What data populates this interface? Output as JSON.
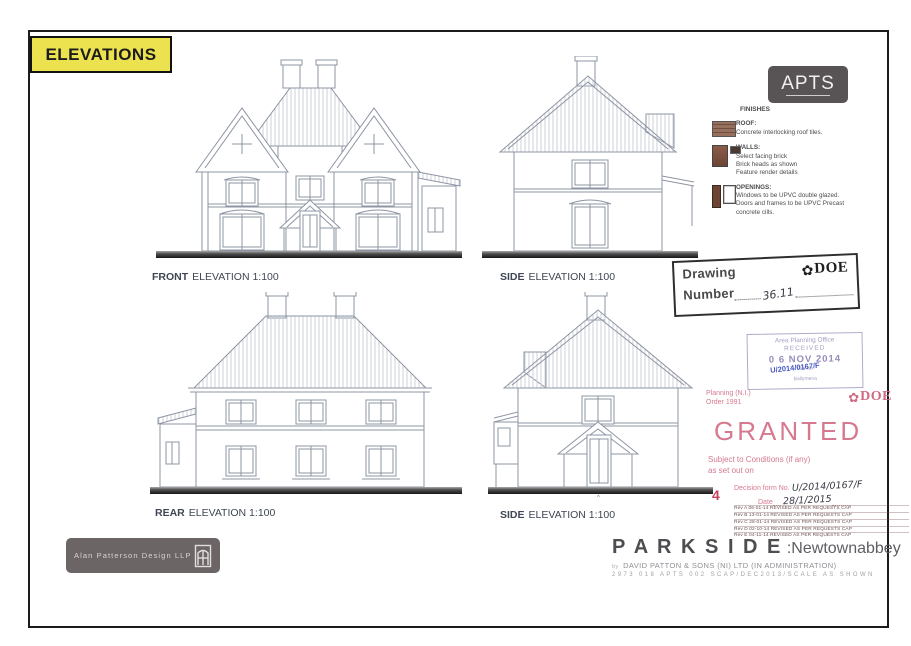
{
  "sheet": {
    "title": "ELEVATIONS"
  },
  "logos": {
    "apts": "APTS",
    "designer": "Alan Patterson Design LLP"
  },
  "elevation_labels": {
    "front_bold": "FRONT",
    "front_rest": "ELEVATION 1:100",
    "side_top_bold": "SIDE",
    "side_top_rest": "ELEVATION 1:100",
    "rear_bold": "REAR",
    "rear_rest": "ELEVATION 1:100",
    "side_bottom_bold": "SIDE",
    "side_bottom_rest": "ELEVATION 1:100",
    "ground_caret": "^"
  },
  "finishes": {
    "heading": "FINISHES",
    "roof_title": "ROOF:",
    "roof_line1": "Concrete interlocking roof tiles.",
    "walls_title": "WALLS:",
    "walls_line1": "Select facing brick",
    "walls_line2": "Brick heads as shown",
    "walls_line3": "Feature render details",
    "openings_title": "OPENINGS:",
    "openings_line1": "Windows to be UPVC double glazed.",
    "openings_line2": "Doors and frames to be UPVC Precast",
    "openings_line3": "concrete cills."
  },
  "drawing_number_stamp": {
    "label_line1": "Drawing",
    "label_line2": "Number",
    "value": "36.11",
    "doe_glyph": "✿",
    "doe_text": "DOE"
  },
  "received_stamp": {
    "office_line": "Area Planning Office",
    "received": "RECEIVED",
    "date": "0 6 NOV 2014",
    "file_label": "File No",
    "file_value": "U/2014/0167/F",
    "district": "Ballymena"
  },
  "granted_stamp": {
    "planning": "Planning (N.I.)",
    "order": "Order 1991",
    "doe_glyph": "✿",
    "doe_text": "DOE",
    "title": "GRANTED",
    "cond1": "Subject to Conditions (if any)",
    "cond2": "as set out on",
    "decision_label": "Decision form No.",
    "decision_value": "U/2014/0167/F",
    "date_label": "Date",
    "date_value": "28/1/2015",
    "corner_number": "4"
  },
  "revisions": [
    "Rev A 06-01-14 REVISED AS PER REQUESTS CAP",
    "Rev B 13-01-14 REVISED AS PER REQUESTS CAP",
    "Rev C 28-01-14 REVISED AS PER REQUESTS CAP",
    "Rev D 02-10-14 REVISED AS PER REQUESTS CAP",
    "Rev E 04-11-14 REVISED AS PER REQUESTS CAP"
  ],
  "title_block": {
    "project": "P A R K S I D E",
    "location": ":Newtownabbey",
    "by": "by",
    "client": "DAVID PATTON & SONS (NI) LTD (IN ADMINISTRATION)",
    "ref": "2973 018 APTS 002 SCAP/DEC2013/SCALE AS SHOWN"
  },
  "colors": {
    "highlight_yellow": "#ece24f",
    "granted_red": "#d6798f",
    "received_purple": "#a79ec2",
    "ink_blue": "#4656c0",
    "drawing_line_gray": "#8d94a3",
    "badge_gray": "#585355"
  }
}
